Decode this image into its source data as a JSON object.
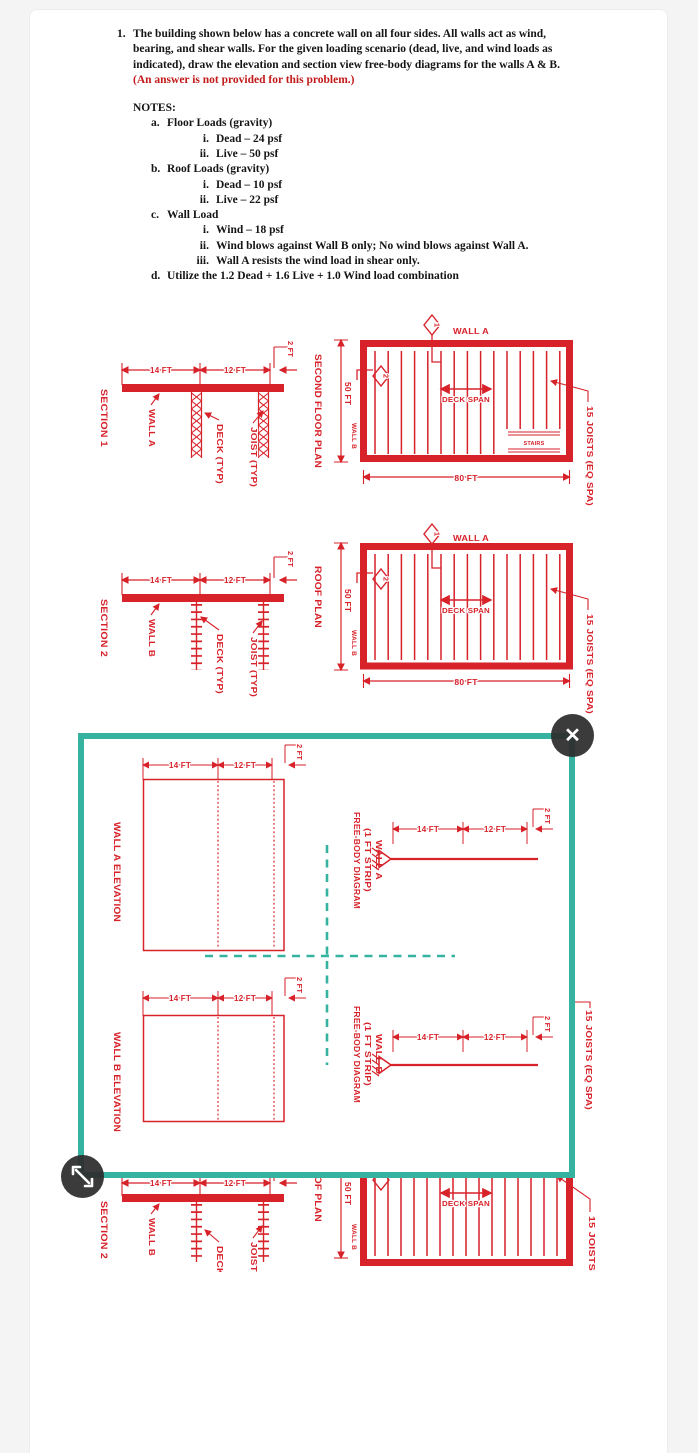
{
  "colors": {
    "drawing_red": "#d7222a",
    "overlay_teal": "#36b3a0",
    "page_bg": "#f4f4f5",
    "card_bg": "#ffffff",
    "button_bg": "#2c2c2c",
    "statement_red": "#c21a1a"
  },
  "problem": {
    "number": "1.",
    "statement": "The building shown below has a concrete wall on all four sides.  All walls act as wind, bearing, and shear walls.  For the given loading scenario (dead, live, and wind loads as indicated), draw the elevation and section view free-body diagrams for the walls A & B. ",
    "statement_red": "(An answer is not provided for this problem.)",
    "notes_title": "NOTES:",
    "notes": [
      {
        "label": "a.",
        "text": "Floor Loads (gravity)",
        "sub": [
          {
            "label": "i.",
            "text": "Dead – 24 psf"
          },
          {
            "label": "ii.",
            "text": "Live – 50 psf"
          }
        ]
      },
      {
        "label": "b.",
        "text": "Roof Loads (gravity)",
        "sub": [
          {
            "label": "i.",
            "text": "Dead – 10 psf"
          },
          {
            "label": "ii.",
            "text": "Live – 22 psf"
          }
        ]
      },
      {
        "label": "c.",
        "text": "Wall Load",
        "sub": [
          {
            "label": "i.",
            "text": "Wind – 18 psf"
          },
          {
            "label": "ii.",
            "text": "Wind blows against Wall B only; No wind blows against Wall A."
          },
          {
            "label": "iii.",
            "text": "Wall A resists the wind load in shear only."
          }
        ]
      },
      {
        "label": "d.",
        "text": "Utilize the 1.2 Dead + 1.6 Live + 1.0 Wind load combination",
        "sub": []
      }
    ]
  },
  "dims": {
    "d14": "14 FT",
    "d12": "12 FT",
    "d2": "2 FT",
    "d50": "50 FT",
    "d80": "80 FT"
  },
  "labels": {
    "section1": "SECTION 1",
    "section2": "SECTION 2",
    "second_floor_plan": "SECOND FLOOR PLAN",
    "roof_plan": "ROOF PLAN",
    "wall_a": "WALL A",
    "wall_b": "WALL B",
    "deck_typ": "DECK (TYP)",
    "joist_typ": "JOIST (TYP)",
    "deck_span": "DECK SPAN",
    "stairs": "STAIRS",
    "joists_eq": "15 JOISTS (EQ SPA)",
    "joists_short": "15 JOISTS",
    "marker1": "1",
    "marker2": "2",
    "wall_a_elev": "WALL A ELEVATION",
    "wall_b_elev": "WALL B ELEVATION",
    "fbd_title": "FREE-BODY DIAGRAM",
    "fbd_strip": "(1 FT STRIP)",
    "fbd_wall_a": "WALL A",
    "fbd_wall_b": "WALL B"
  },
  "overlay": {
    "close_glyph": "✕"
  }
}
